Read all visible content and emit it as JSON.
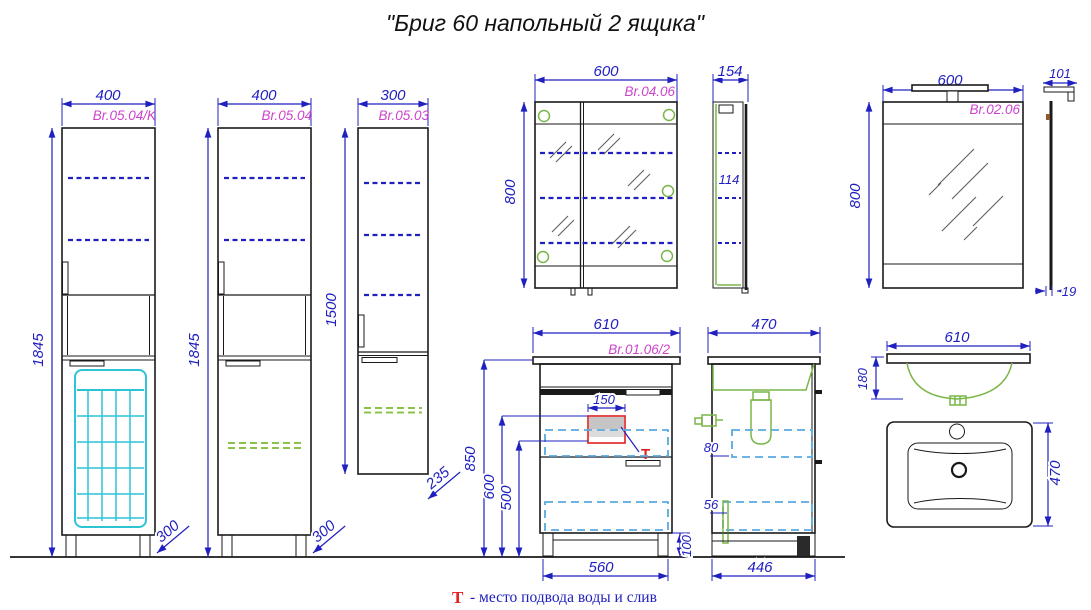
{
  "title": "\"Бриг 60 напольный 2 ящика\"",
  "note": {
    "symbol": "Т",
    "text": "- место подвода воды и слив"
  },
  "colors": {
    "dimension_blue": "#2020c0",
    "label_magenta": "#cc44cc",
    "line_black": "#1a1a1a",
    "shelf_green": "#8bc34a",
    "fixture_green": "#7ab648",
    "basket_cyan": "#2ec4d6",
    "drawer_dash_blue": "#58aadf",
    "supply_red": "#e02020"
  },
  "views": {
    "tall_cabinet_k": {
      "label": "Br.05.04/K",
      "width": "400",
      "height": "1845",
      "depth": "300"
    },
    "tall_cabinet": {
      "label": "Br.05.04",
      "width": "400",
      "height": "1845",
      "depth": "300"
    },
    "wall_cabinet": {
      "label": "Br.05.03",
      "width": "300",
      "height": "1500",
      "depth": "235"
    },
    "mirror_cabinet": {
      "label": "Br.04.06",
      "width": "600",
      "height": "800",
      "depth": "154",
      "shelf_gap": "114"
    },
    "mirror": {
      "label": "Br.02.06",
      "width": "600",
      "height": "800",
      "lamp_depth": "101",
      "thickness": "19"
    },
    "vanity": {
      "label": "Br.01.06/2",
      "width": "610",
      "height": "850",
      "supply_height": "600",
      "drain_height": "500",
      "supply_width": "150",
      "base_width": "560",
      "leg_height": "100",
      "supply_mark": "Т"
    },
    "vanity_side": {
      "depth": "470",
      "top_gap": "80",
      "bottom_gap": "56",
      "base_depth": "446"
    },
    "sink": {
      "width": "610",
      "bowl_depth": "180",
      "depth": "470"
    }
  }
}
